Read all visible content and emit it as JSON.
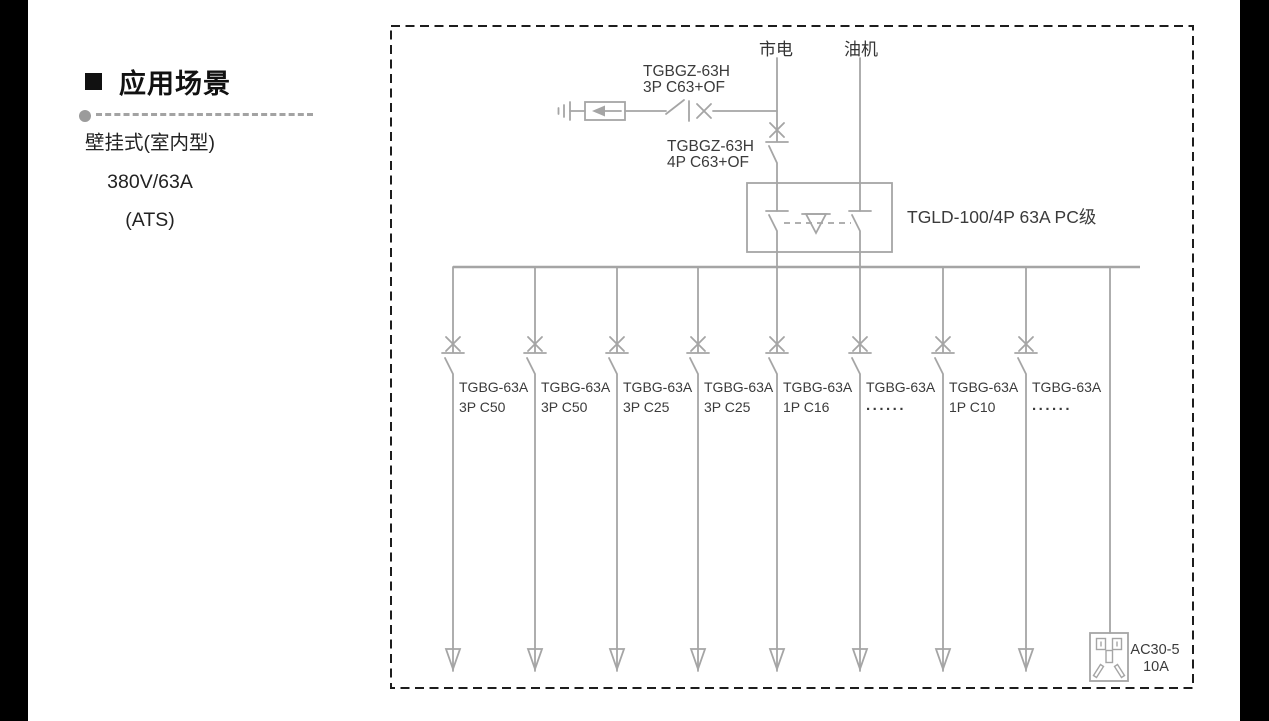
{
  "left_panel": {
    "title": "应用场景",
    "lines": [
      "壁挂式(室内型)",
      "380V/63A",
      "(ATS)"
    ]
  },
  "diagram": {
    "sources": {
      "mains": "市电",
      "generator": "油机"
    },
    "spd_breaker": {
      "model": "TGBGZ-63H",
      "spec": "3P C63+OF"
    },
    "main_breaker": {
      "model": "TGBGZ-63H",
      "spec": "4P C63+OF"
    },
    "ats": {
      "label": "TGLD-100/4P 63A PC级"
    },
    "branches": [
      {
        "model": "TGBG-63A",
        "spec": "3P C50"
      },
      {
        "model": "TGBG-63A",
        "spec": "3P C50"
      },
      {
        "model": "TGBG-63A",
        "spec": "3P C25"
      },
      {
        "model": "TGBG-63A",
        "spec": "3P C25"
      },
      {
        "model": "TGBG-63A",
        "spec": "1P C16"
      },
      {
        "model": "TGBG-63A",
        "spec": "......"
      },
      {
        "model": "TGBG-63A",
        "spec": "1P C10"
      },
      {
        "model": "TGBG-63A",
        "spec": "......"
      }
    ],
    "socket": {
      "model": "AC30-5",
      "rating": "10A"
    }
  },
  "colors": {
    "wire_gray": "#a5a5a5",
    "border_dash": "#1d1d1d",
    "text_dark": "#3b3b3b",
    "side_bars": "#000000"
  }
}
